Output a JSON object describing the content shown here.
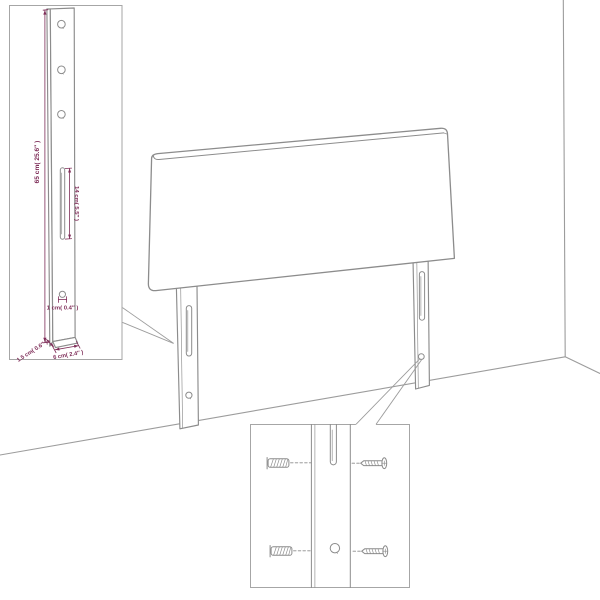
{
  "figure": {
    "type": "furniture-assembly-diagram",
    "subject": "upholstered headboard with two mounting legs, magnified detail callouts",
    "colors": {
      "background": "#ffffff",
      "drawing_line": "#8c8c8c",
      "room_line": "#9c9c9c",
      "callout_box_border": "#a6a6a6",
      "dimension": "#7e2d58"
    }
  },
  "left_detail_box": {
    "description": "magnified mounting leg with three holes, long slot and small hole",
    "height_label": "65 cm( 25.6″ )",
    "slot_label": "14 cm( 5.5″ )",
    "hole_label": "1 cm( 0.4″ )",
    "thickness_label": "1.5 cm( 0.6″ )",
    "width_label": "6 cm( 2.4″ )"
  },
  "right_detail_box": {
    "description": "magnified leg slot and hole with wall plugs and screws",
    "components": [
      "wall plug",
      "wall plug",
      "screw",
      "screw"
    ]
  }
}
